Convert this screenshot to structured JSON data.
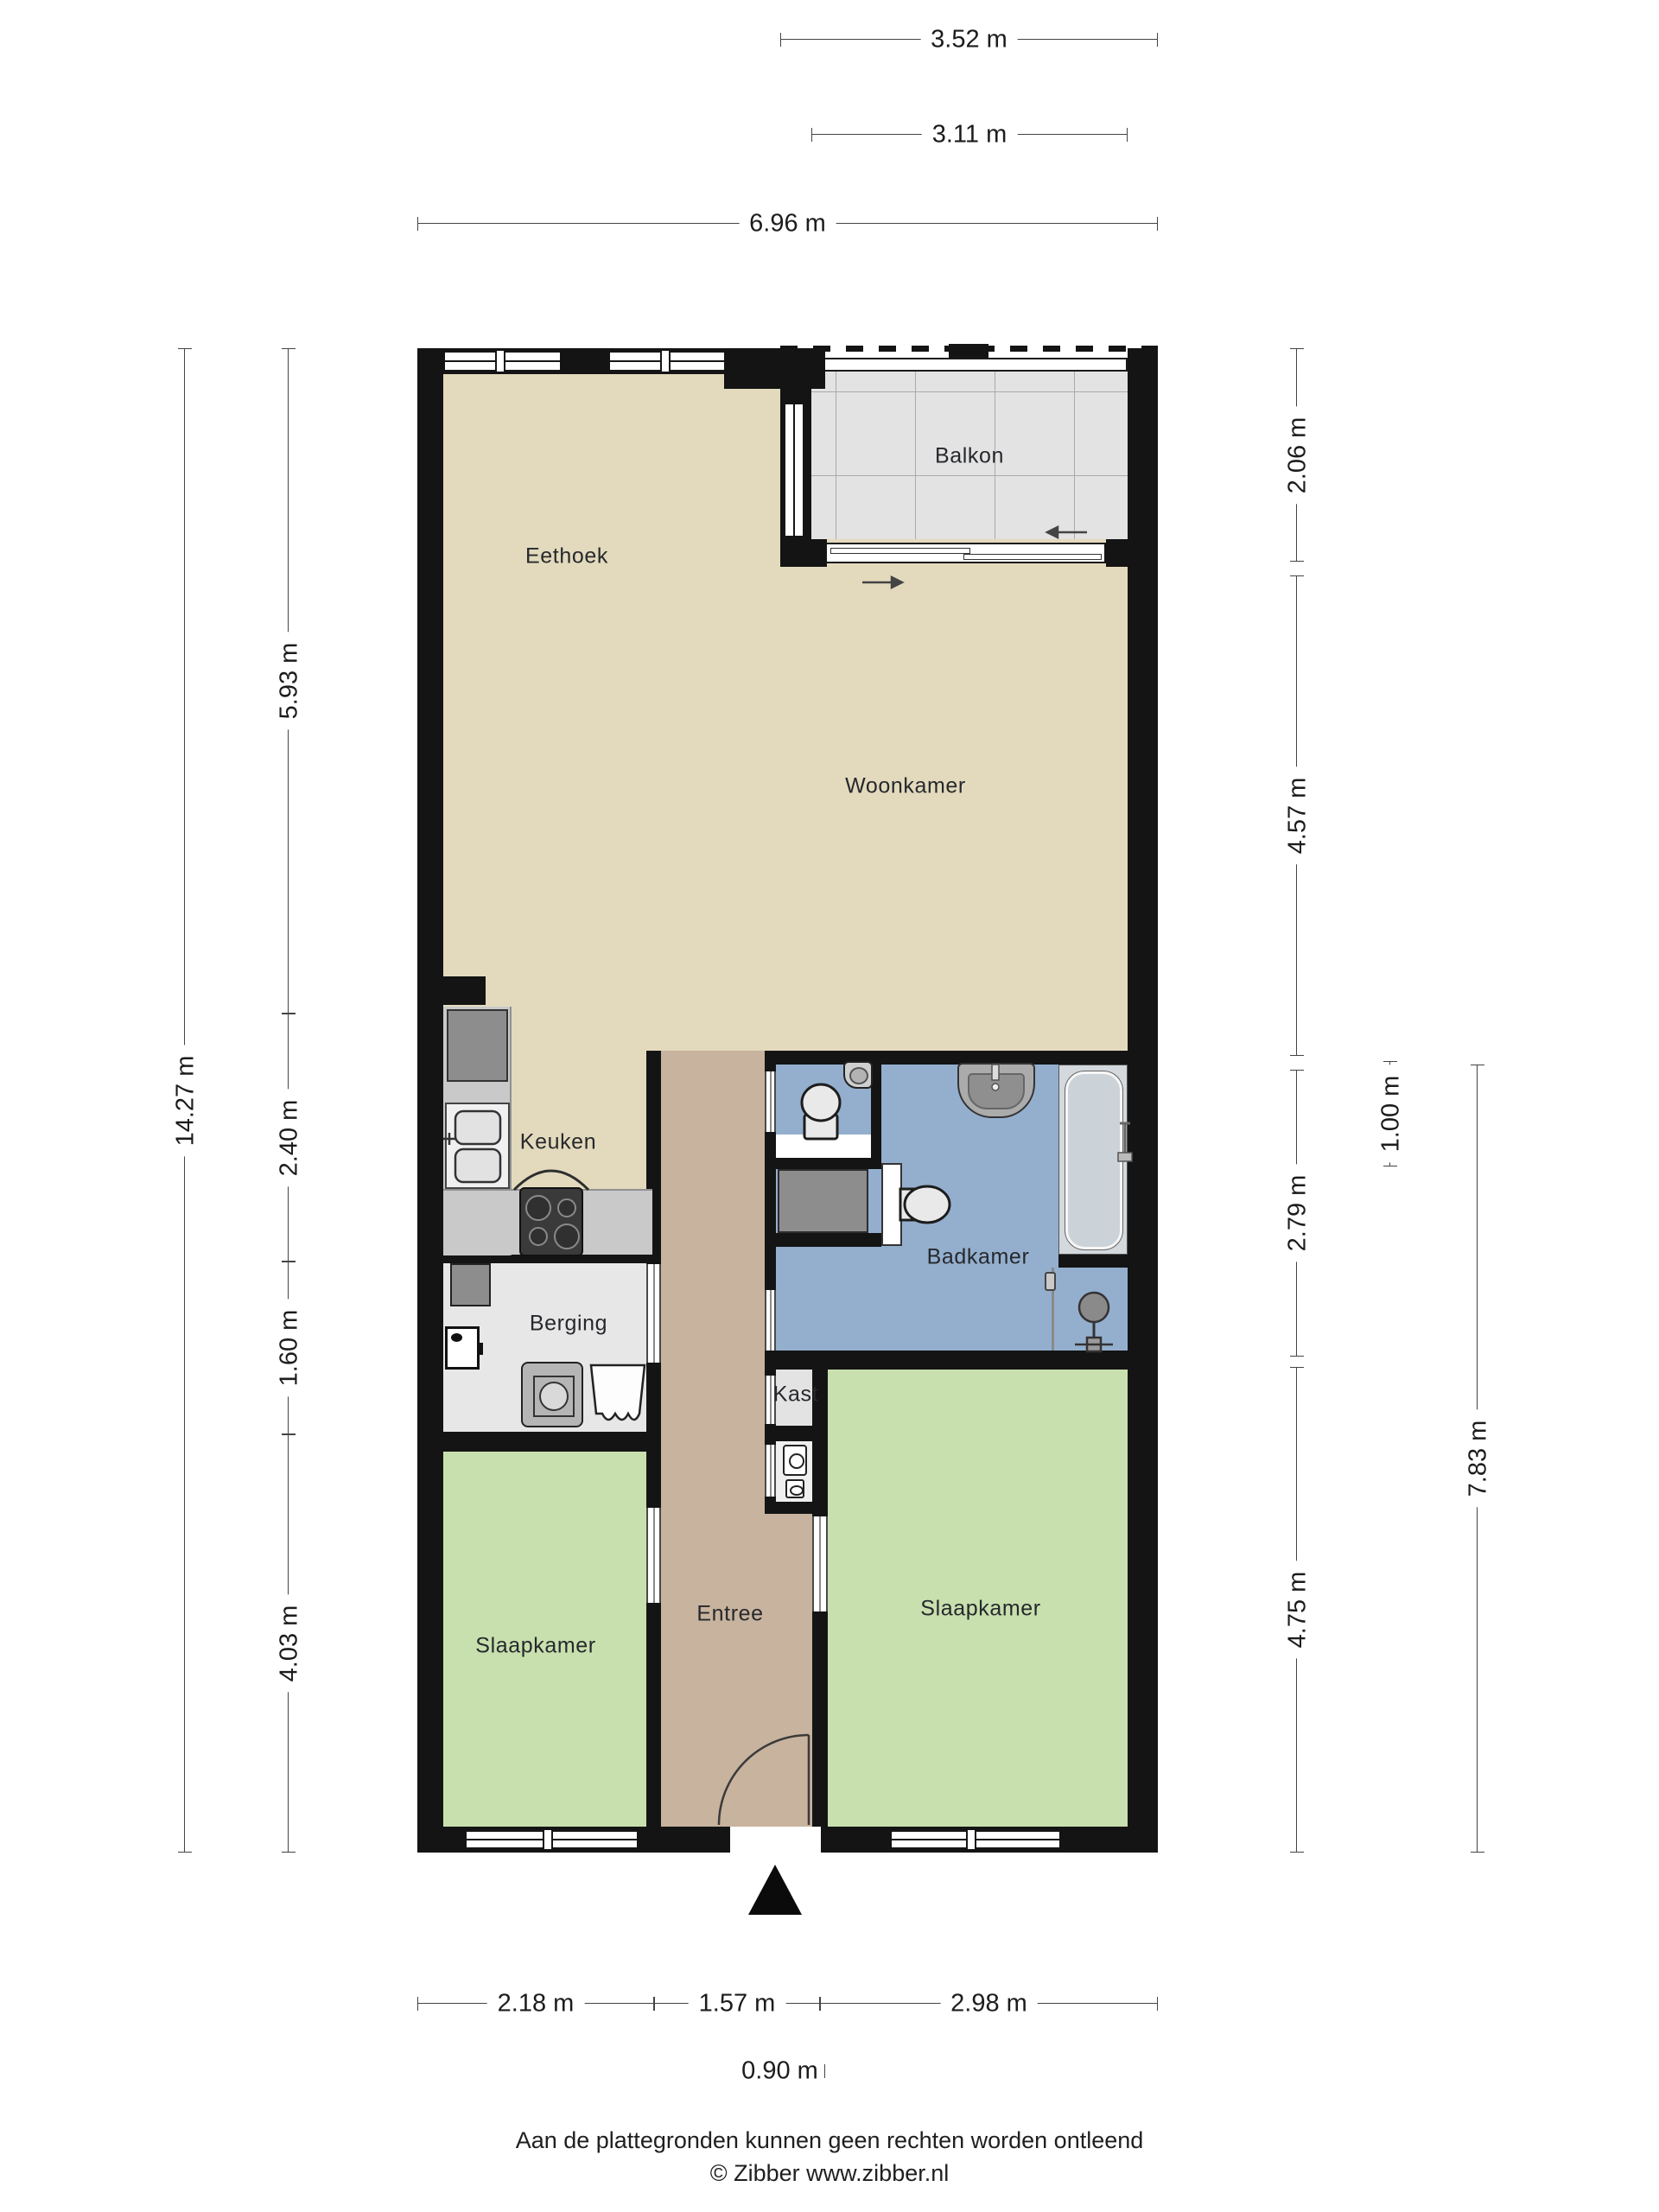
{
  "title": "Plattegrond appartement",
  "rooms": {
    "eethoek": "Eethoek",
    "balkon": "Balkon",
    "woonkamer": "Woonkamer",
    "keuken": "Keuken",
    "badkamer": "Badkamer",
    "berging": "Berging",
    "kast": "Kast",
    "entree": "Entree",
    "slaapkamer_links": "Slaapkamer",
    "slaapkamer_rechts": "Slaapkamer"
  },
  "dimensions": {
    "top": [
      {
        "label": "3.52 m"
      },
      {
        "label": "3.11 m"
      },
      {
        "label": "6.96 m"
      }
    ],
    "left": [
      {
        "label": "14.27 m"
      },
      {
        "label": "5.93 m"
      },
      {
        "label": "2.40 m"
      },
      {
        "label": "1.60 m"
      },
      {
        "label": "4.03 m"
      }
    ],
    "right": [
      {
        "label": "2.06 m"
      },
      {
        "label": "4.57 m"
      },
      {
        "label": "2.79 m"
      },
      {
        "label": "1.00 m"
      },
      {
        "label": "4.75 m"
      },
      {
        "label": "7.83 m"
      }
    ],
    "bottom": [
      {
        "label": "2.18 m"
      },
      {
        "label": "1.57 m"
      },
      {
        "label": "2.98 m"
      },
      {
        "label": "0.90 m"
      }
    ]
  },
  "footer": {
    "disclaimer": "Aan de plattegronden kunnen geen rechten worden ontleend",
    "credit": "© Zibber www.zibber.nl"
  },
  "colors": {
    "c-wall": "#141414",
    "c-beige": "#e3dabd",
    "c-tan": "#c7b39e",
    "c-green": "#c8e0ae",
    "c-blue": "#94afce",
    "c-grayfloor": "#e7e7e7",
    "c-tile": "#e3e3e3",
    "c-counter": "#c9c9c9",
    "c-appliance": "#8d8d8d",
    "c-stove": "#3a3a3a",
    "c-tub": "#ccd3d8",
    "c-dim": "#444444",
    "c-text": "#26282c"
  }
}
